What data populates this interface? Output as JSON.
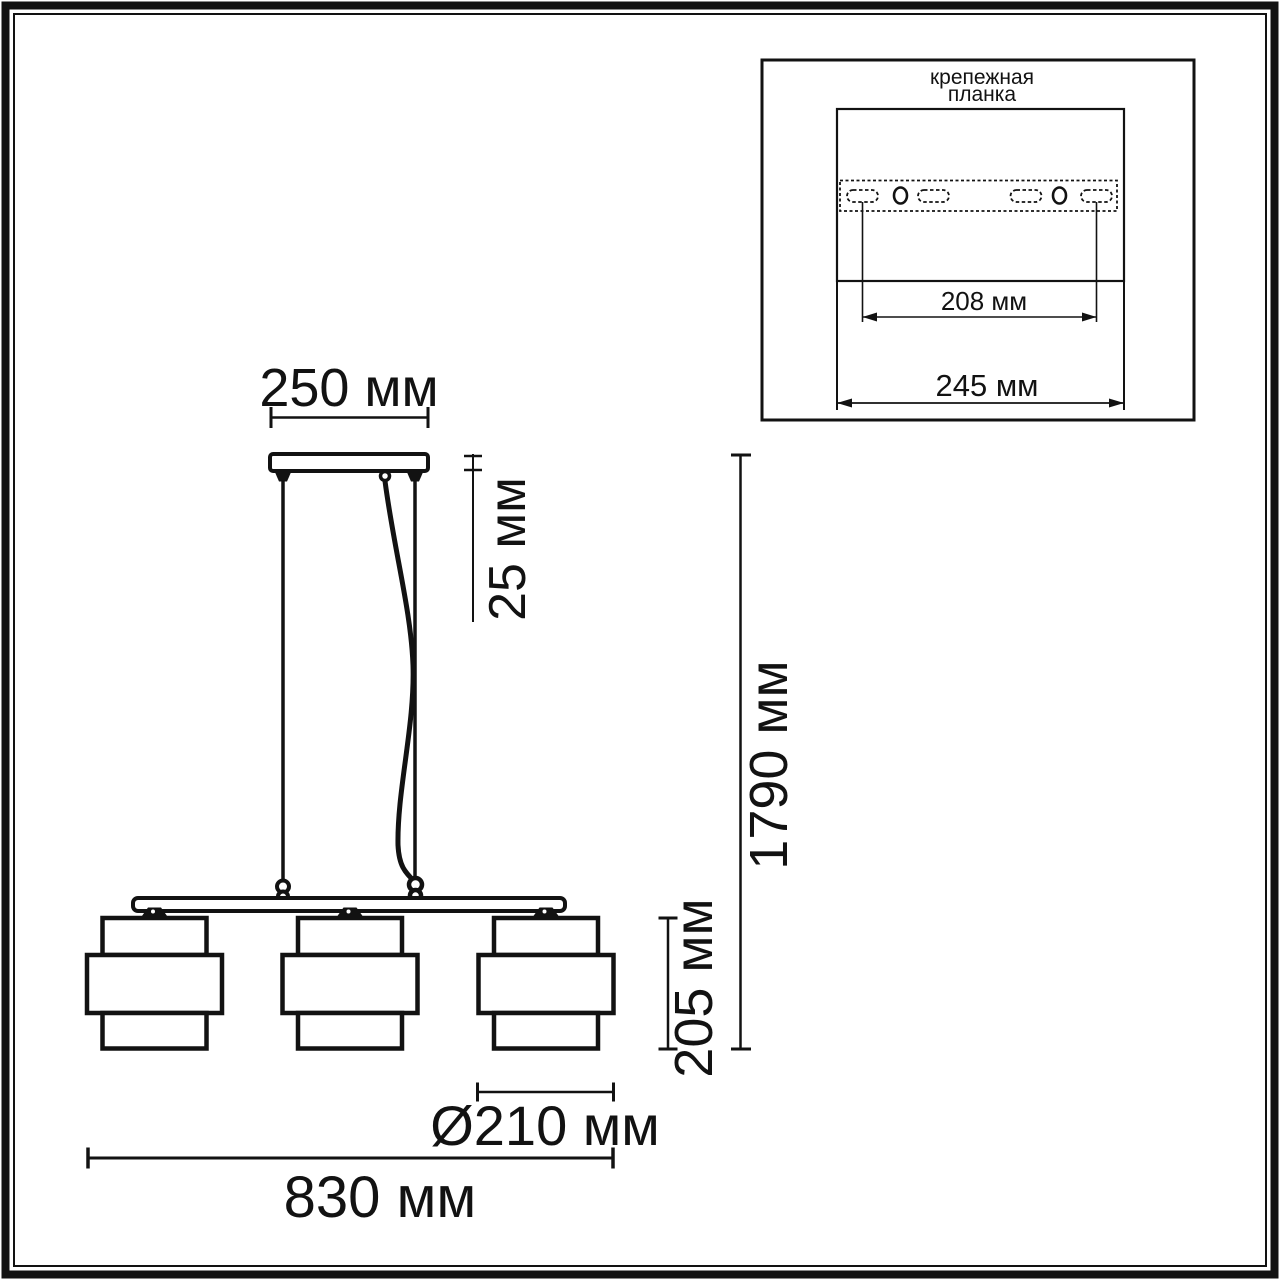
{
  "colors": {
    "ink": "#121212",
    "background": "#ffffff"
  },
  "drawing": {
    "dim_canopy_width": "250 мм",
    "dim_canopy_thickness": "25 мм",
    "dim_overall_height": "1790 мм",
    "dim_shade_height": "205 мм",
    "dim_shade_diameter": "Ø210 мм",
    "dim_fixture_length": "830 мм"
  },
  "inset": {
    "title_line1": "крепежная",
    "title_line2": "планка",
    "dim_hole_spacing": "208 мм",
    "dim_plate_length": "245 мм"
  }
}
